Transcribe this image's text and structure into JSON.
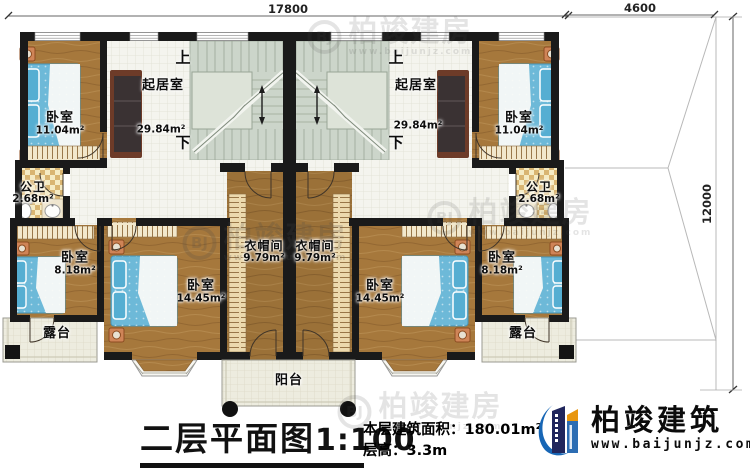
{
  "dims": {
    "top_width": "17800",
    "roof_width": "4600",
    "right_height": "12000"
  },
  "stairs": {
    "up": "上",
    "down": "下"
  },
  "rooms": {
    "tl_bedroom": {
      "name": "卧室",
      "area": "11.04m²"
    },
    "tr_bedroom": {
      "name": "卧室",
      "area": "11.04m²"
    },
    "left_living": {
      "name": "起居室",
      "area": "29.84m²"
    },
    "right_living": {
      "name": "起居室",
      "area": "29.84m²"
    },
    "left_bath": {
      "name": "公卫",
      "area": "2.68m²"
    },
    "right_bath": {
      "name": "公卫",
      "area": "2.68m²"
    },
    "left_closet": {
      "name": "衣帽间",
      "area": "9.79m²"
    },
    "right_closet": {
      "name": "衣帽间",
      "area": "9.79m²"
    },
    "bl_small_bedroom": {
      "name": "卧室",
      "area": "8.18m²"
    },
    "br_small_bedroom": {
      "name": "卧室",
      "area": "8.18m²"
    },
    "bl_large_bedroom": {
      "name": "卧室",
      "area": "14.45m²"
    },
    "br_large_bedroom": {
      "name": "卧室",
      "area": "14.45m²"
    },
    "left_terrace": {
      "name": "露台"
    },
    "right_terrace": {
      "name": "露台"
    },
    "balcony": {
      "name": "阳台"
    }
  },
  "title": {
    "main": "二层平面图",
    "scale": "1:100"
  },
  "info": {
    "area_label": "本层建筑面积：",
    "area_value": "180.01m²",
    "height_label": "层高：",
    "height_value": "3.3m"
  },
  "logo": {
    "name": "柏竣建筑",
    "url": "www.baijunjz.com"
  },
  "watermark": {
    "text": "柏竣建房",
    "url": "www.baijunjz.com",
    "ring": "BJ"
  }
}
